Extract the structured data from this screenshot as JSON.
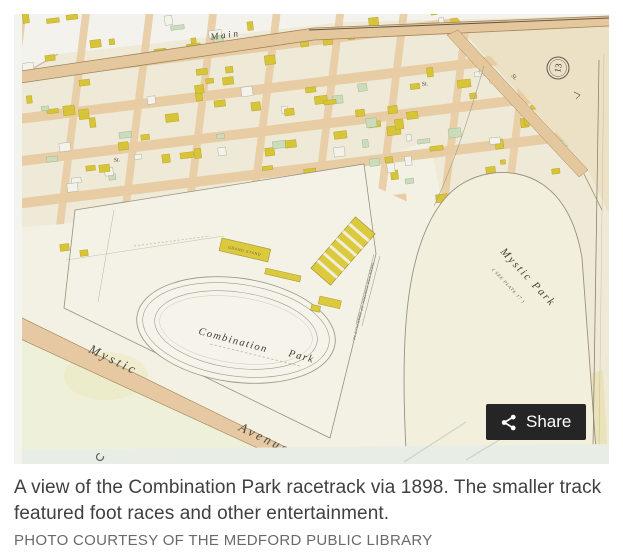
{
  "photo": {
    "share_label": "Share"
  },
  "map_labels": {
    "main_street": "Main",
    "st_a": "St.",
    "st_b": "St.",
    "st_c": "St.",
    "plate_number": "13",
    "grand_stand": "GRAND STAND",
    "combination_word": "Combination",
    "park_word": "Park",
    "mystic_park": "Mystic Park",
    "mystic_park_note": "( SEE PLATE 17 )",
    "mystic_word": "Mystic",
    "avenue_word": "Avenue",
    "granville_note": "TAKEN FOR CONTROL OF GRANVILLE AV."
  },
  "caption": {
    "text": "A view of the Combination Park racetrack via 1898. The smaller track featured foot races and other entertainment.",
    "credit": "PHOTO COURTESY OF THE MEDFORD PUBLIC LIBRARY"
  },
  "colors": {
    "share_bg": "#252525",
    "share_text": "#ffffff",
    "caption_text": "#404040",
    "credit_text": "#6a6a6a",
    "map_paper": "#efead7",
    "street_tan": "#e8cda4",
    "building_yellow": "#d7c437",
    "building_green": "#cbdcbd"
  }
}
